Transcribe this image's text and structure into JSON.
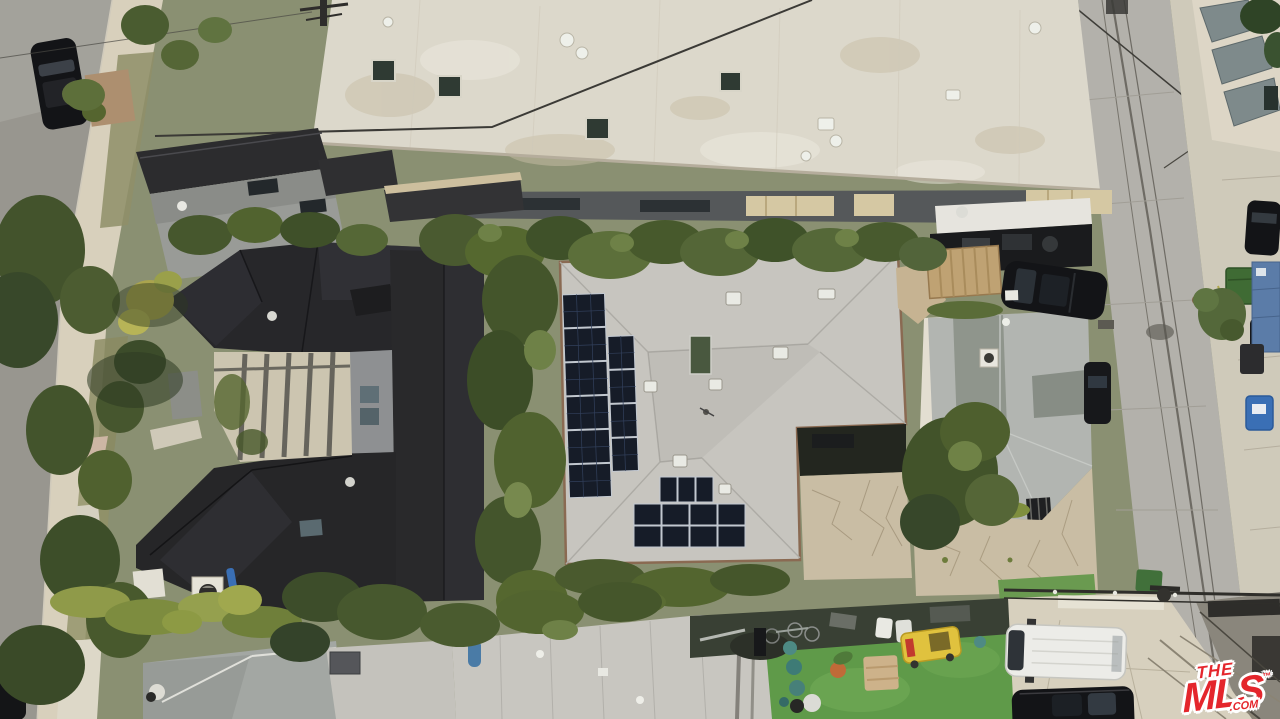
{
  "meta": {
    "type": "aerial-drone-photograph",
    "subject": "overhead view of a residential block: large flat white commercial roof at top, dark charcoal shingled house on the left, light-gray hip roof with solar panels in the center, smaller gray house on the right, streets with parked cars on both edges, rear lawn and parking pad at bottom"
  },
  "watermark": {
    "line1": "THE",
    "line2": "MLS",
    "trademark": "™",
    "suffix": ".COM"
  },
  "colors": {
    "brand": "#e4262c",
    "street": "#98968f",
    "streetlight": "#a8a6a0",
    "sidewalk": "#d8d0bc",
    "dirt": "#ad8f6f",
    "whiteroof": "#dcd8cb",
    "stain": "#c7bda6",
    "awning": "#d5c8a3",
    "darkroof": "#2c2c2e",
    "darkhouse": "#27272a",
    "courtyard": "#ccc5b0",
    "centerroof": "#c7c5bf",
    "eave": "#8a6a52",
    "solar": "#161c28",
    "solarframe": "#c2c8d0",
    "skylightglass": "#49583f",
    "rightroof": "#b2b5b1",
    "olivepanel": "#8f958c",
    "alley": "#b3b1ab",
    "rsidewalk": "#cfcaba",
    "slate": "#7e8a8b",
    "lawn": "#5f9a49",
    "pad": "#d7d0be",
    "flagstone": "#c9bda4",
    "crate": "#bfa273",
    "greenbin": "#3f6b34",
    "bluebin": "#3a6fb5",
    "carblack": "#131417",
    "vanwhite": "#ecece8",
    "treedark": "#3c4c28",
    "treemid": "#53652f",
    "treelight": "#6e8147"
  },
  "scene": {
    "elements": [
      {
        "name": "white-commercial-roof",
        "description": "large flat off-white roof with skylights, vents and stains, top of frame"
      },
      {
        "name": "dark-house-complex",
        "description": "charcoal shingle multi-wing roof with central pergola courtyard, left"
      },
      {
        "name": "solar-house",
        "description": "light gray shingle hip roof with two columns of solar panels and lower solar array, center"
      },
      {
        "name": "solar-panels",
        "description": "dark photovoltaic modules, 6+4 on west slope and 3+8 array on south slope"
      },
      {
        "name": "right-house",
        "description": "small gray cross-hip roof house with white chimney"
      },
      {
        "name": "left-street",
        "description": "asphalt street with parked dark cars and beige sidewalk parkway"
      },
      {
        "name": "right-alley",
        "description": "cracked concrete street running vertically on the right"
      },
      {
        "name": "trash-bins",
        "description": "green dumpster, black bin and blue recycling bin on right sidewalk"
      },
      {
        "name": "black-suv-carport",
        "description": "black SUV parked beside wooden crate structure, upper right"
      },
      {
        "name": "white-van",
        "description": "white van on rear parking pad, bottom right"
      },
      {
        "name": "black-suv-bottom",
        "description": "black SUV below the white van, bottom right"
      },
      {
        "name": "rear-lawn",
        "description": "bright green turf with yellow cart, tan sofa, planter and teal exercise balls"
      },
      {
        "name": "garage-flat-roof",
        "description": "long light gray flat garage roof across the bottom"
      },
      {
        "name": "power-lines",
        "description": "utility cables crossing the roofs and rear street with pole"
      },
      {
        "name": "mls-watermark",
        "description": "red THE MLS .COM logo, bottom right corner"
      }
    ]
  }
}
